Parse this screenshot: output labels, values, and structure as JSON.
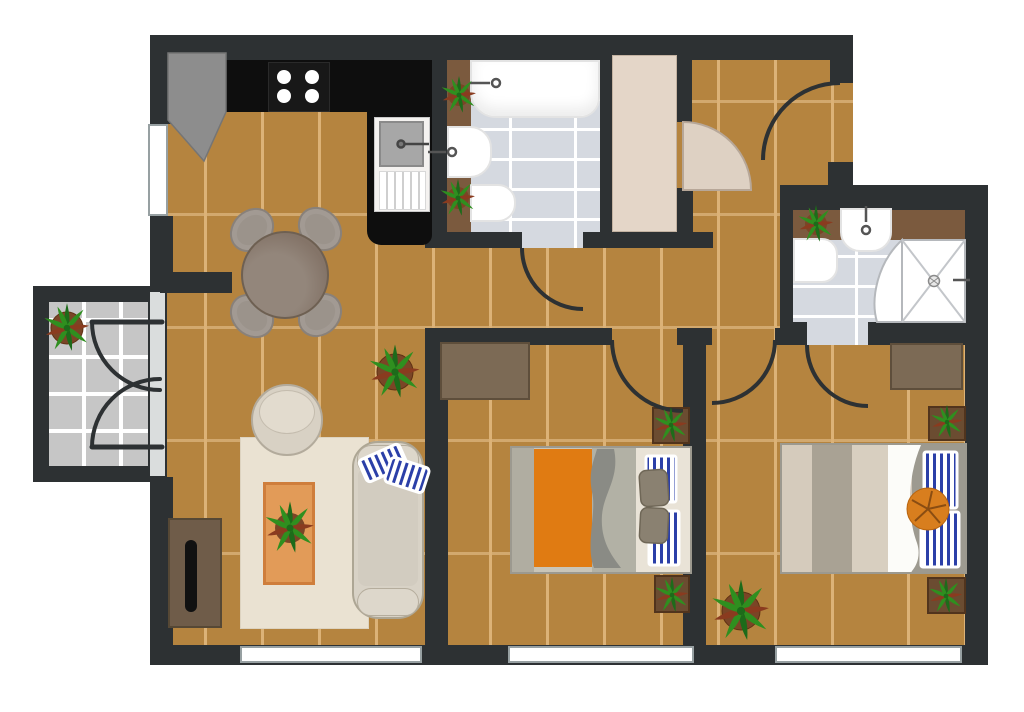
{
  "title": "Apartment floor plan — two bedrooms, two bathrooms, kitchen with dining area, living room, hallway with closet, and balcony",
  "colors": {
    "wall": "#2d3133",
    "wood": "#b5843f",
    "wood_gap": "#dcb277",
    "tile": "#d5d9e0",
    "grout": "#ffffff",
    "balcony_tile": "#c6c6c6",
    "counter_black": "#0e0e0e",
    "counter_brown": "#7b5a3e",
    "closet": "#e4d6c8",
    "door_leaf": "#ded1c3",
    "rug": "#eae2d2",
    "coffee_table": "#e29b58",
    "blanket_orange": "#e07b12",
    "pouf_orange": "#d87e1e",
    "stripe_blue": "#2b3fa8",
    "plant_green": "#2f8f1f",
    "plant_green_dark": "#1d6b1a",
    "plant_red": "#8a3b1f",
    "pot": "#7a4526",
    "dresser": "#7c6a55",
    "nightstand": "#6b4c31",
    "sofa": "#d8d2c6",
    "bed_taupe": "#a9a294",
    "bed_cream": "#d8cfc0",
    "headboard": "#9d9a90",
    "cushion_taupe": "#8a8171",
    "table_round": "#847468",
    "chair": "#9b938b",
    "window": "#ffffff",
    "threshold": "#dadddd",
    "fixture": "#ffffff",
    "sink_basin": "#a7a7a7",
    "tv": "#111111",
    "tv_stand": "#6f5c49",
    "wave_gray": "#8a8b85"
  },
  "rooms": [
    {
      "id": "kitchen",
      "label": "Kitchen",
      "furniture": [
        "L-shaped black counter",
        "stove with 4 burners",
        "sink with drying rack",
        "corner cabinet",
        "window"
      ]
    },
    {
      "id": "dining-area",
      "label": "Dining area",
      "furniture": [
        "round table",
        "4 chairs"
      ]
    },
    {
      "id": "living-room",
      "label": "Living room",
      "furniture": [
        "sofa with 2 striped cushions",
        "round armchair",
        "rug",
        "coffee table with plant",
        "tv stand with tv",
        "floor plant",
        "window"
      ]
    },
    {
      "id": "bathroom",
      "label": "Bathroom",
      "furniture": [
        "bathtub",
        "sink",
        "toilet",
        "vanity counter with 2 plants",
        "tiled floor",
        "door"
      ]
    },
    {
      "id": "closet",
      "label": "Hallway closet",
      "furniture": [
        "wardrobe",
        "open door leaf"
      ]
    },
    {
      "id": "hallway",
      "label": "Hallway",
      "furniture": [
        "entry door"
      ]
    },
    {
      "id": "ensuite-bathroom",
      "label": "Ensuite bathroom",
      "furniture": [
        "corner shower",
        "sink",
        "toilet",
        "vanity counter with plant",
        "tiled floor",
        "door"
      ]
    },
    {
      "id": "bedroom-1",
      "label": "Bedroom 1",
      "furniture": [
        "double bed with orange blanket",
        "2 striped pillows",
        "2 taupe cushions",
        "dresser",
        "2 nightstands with plants",
        "window",
        "door"
      ]
    },
    {
      "id": "bedroom-2",
      "label": "Bedroom 2",
      "furniture": [
        "double bed with white duvet",
        "2 striped pillows",
        "orange pouf",
        "dresser",
        "2 nightstands with plants",
        "floor plant",
        "window",
        "door"
      ]
    },
    {
      "id": "balcony",
      "label": "Balcony",
      "furniture": [
        "french double doors",
        "potted plant",
        "tiled floor"
      ]
    }
  ]
}
